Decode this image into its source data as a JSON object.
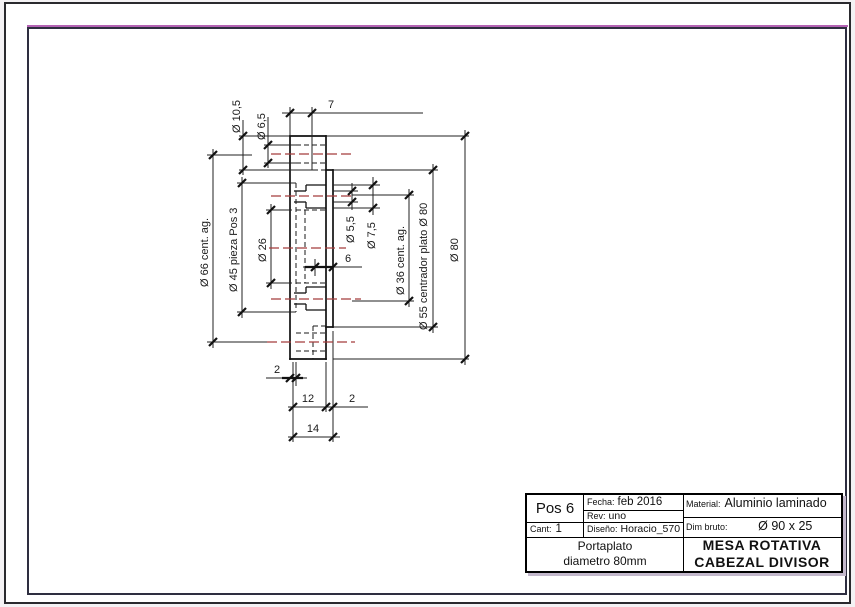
{
  "drawing": {
    "colors": {
      "centerline": "#a43c3c",
      "line": "#1a1a1a"
    },
    "dims": {
      "d10_5": "Ø 10,5",
      "d6_5": "Ø 6,5",
      "len7": "7",
      "d66": "Ø 66 cent. ag.",
      "d45": "Ø 45 pieza Pos 3",
      "d26": "Ø 26",
      "d5_5": "Ø 5,5",
      "d7_5": "Ø 7,5",
      "len6": "6",
      "d36": "Ø 36 cent. ag.",
      "d55": "Ø 55 centrador plato Ø 80",
      "d80": "Ø 80",
      "len2_left": "2",
      "len12": "12",
      "len2_right": "2",
      "len14": "14"
    }
  },
  "title_block": {
    "pos": "Pos 6",
    "cant_label": "Cant:",
    "cant_value": "1",
    "fecha_label": "Fecha:",
    "fecha_value": "feb 2016",
    "rev_label": "Rev:",
    "rev_value": "uno",
    "diseno_label": "Diseño:",
    "diseno_value": "Horacio_570",
    "material_label": "Material:",
    "material_value": "Aluminio laminado",
    "dim_bruto_label": "Dim bruto:",
    "dim_bruto_value": "Ø 90 x 25",
    "part_name_line1": "Portaplato",
    "part_name_line2": "diametro 80mm",
    "title_line1": "MESA ROTATIVA",
    "title_line2": "CABEZAL DIVISOR"
  }
}
